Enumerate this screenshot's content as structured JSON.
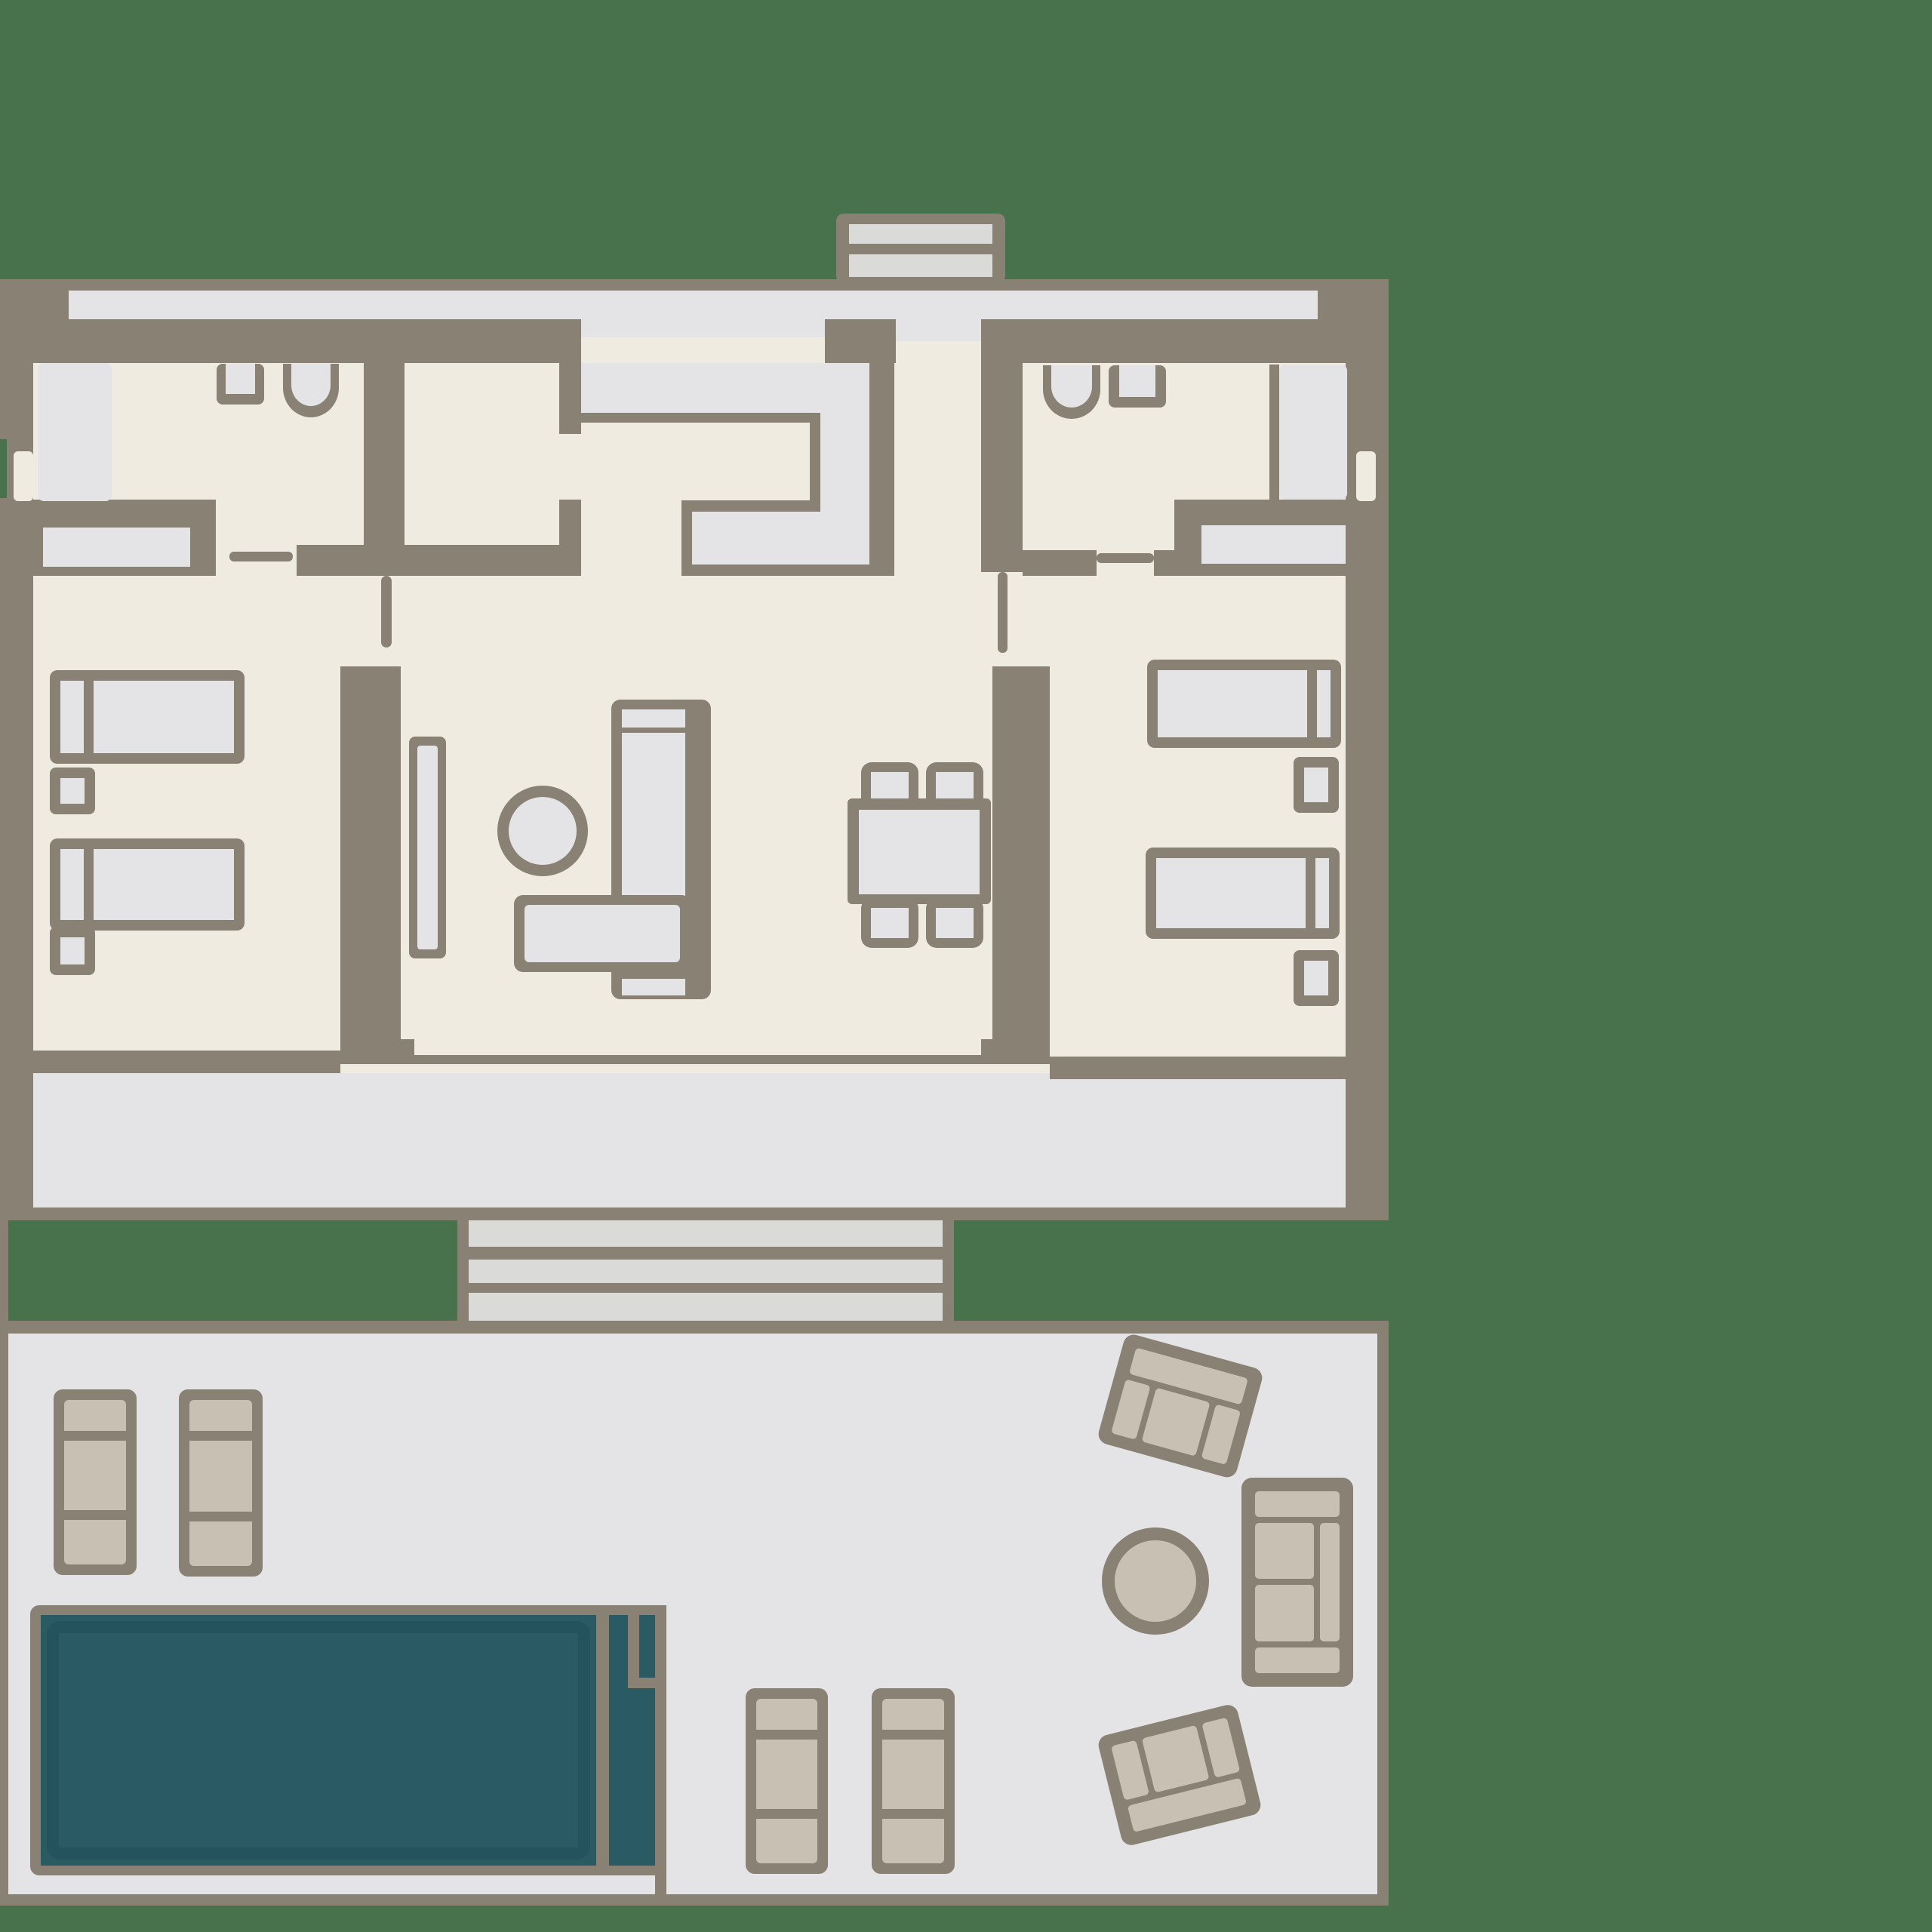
{
  "title": "villa-floor-plan-with-pool-terrace",
  "colors": {
    "background": "#48724C",
    "green_inset": "#47724B",
    "wall": "#8A8175",
    "floor": "#F0EBE0",
    "light": "#E4E4E6",
    "light2": "#DADAD9",
    "tan": "#C8C1B3",
    "pool": "#2A5A64",
    "pool_shadow": "#214E58"
  },
  "plan": {
    "rooms": [
      {
        "name": "bedroom-left",
        "furniture": [
          "bed",
          "bed",
          "nightstand",
          "nightstand",
          "wardrobe"
        ]
      },
      {
        "name": "bathroom-left",
        "furniture": [
          "shower",
          "sink",
          "toilet"
        ]
      },
      {
        "name": "closet-room",
        "furniture": []
      },
      {
        "name": "entry-vestibule",
        "furniture": [
          "built-in-wardrobe"
        ]
      },
      {
        "name": "living-room",
        "furniture": [
          "sideboard",
          "round-stool",
          "sofa",
          "chaise-table"
        ]
      },
      {
        "name": "dining-area",
        "furniture": [
          "dining-table",
          "chair",
          "chair",
          "chair",
          "chair"
        ]
      },
      {
        "name": "bathroom-right",
        "furniture": [
          "toilet",
          "sink",
          "shower"
        ]
      },
      {
        "name": "bedroom-right",
        "furniture": [
          "bed",
          "bed",
          "nightstand",
          "nightstand",
          "wardrobe"
        ]
      }
    ],
    "outdoor": {
      "upper": [
        "entrance-steps-block",
        "covered-terrace-band",
        "garden-inset-left",
        "exterior-steps",
        "garden-inset-right"
      ],
      "lower_terrace": [
        "sunbed",
        "sunbed",
        "sunbed",
        "sunbed",
        "pool-with-ladder-nook",
        "armchair",
        "armchair",
        "outdoor-sofa",
        "round-table"
      ]
    }
  }
}
